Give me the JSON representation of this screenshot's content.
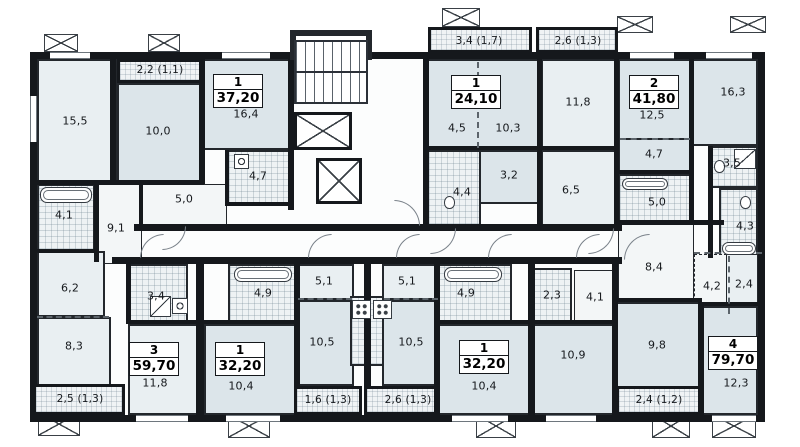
{
  "plan_type": "residential-floor-plan",
  "colors": {
    "wall": "#15181c",
    "room_fill_light": "#e9eff2",
    "room_fill_shaded": "#dce5ea",
    "wet_area_hatch": "#eef2f4",
    "background": "#ffffff"
  },
  "apartments": [
    {
      "rooms": "1",
      "area": "37,20"
    },
    {
      "rooms": "1",
      "area": "24,10"
    },
    {
      "rooms": "2",
      "area": "41,80"
    },
    {
      "rooms": "3",
      "area": "59,70"
    },
    {
      "rooms": "1",
      "area": "32,20"
    },
    {
      "rooms": "1",
      "area": "32,20"
    },
    {
      "rooms": "4",
      "area": "79,70"
    }
  ],
  "room_labels": [
    "15,5",
    "2,2 (1,1)",
    "10,0",
    "16,4",
    "4,7",
    "5,0",
    "4,1",
    "9,1",
    "3,4 (1,7)",
    "4,5",
    "10,3",
    "3,2",
    "4,4",
    "2,6 (1,3)",
    "11,8",
    "6,5",
    "12,5",
    "4,7",
    "5,0",
    "16,3",
    "3,5",
    "4,3",
    "8,4",
    "4,2",
    "2,4",
    "6,2",
    "8,3",
    "2,5 (1,3)",
    "3,4",
    "11,8",
    "4,9",
    "10,4",
    "5,1",
    "10,5",
    "1,6 (1,3)",
    "5,1",
    "10,5",
    "2,6 (1,3)",
    "4,9",
    "10,4",
    "2,3",
    "4,1",
    "10,9",
    "9,8",
    "12,3",
    "2,4 (1,2)"
  ]
}
